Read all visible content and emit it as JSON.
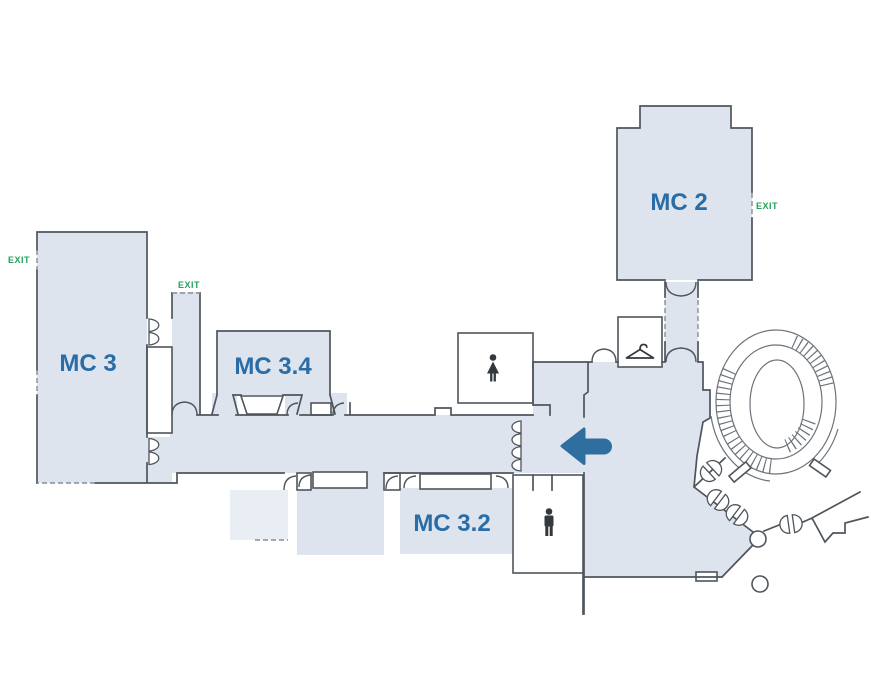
{
  "page": {
    "type": "venue-floor-plan"
  },
  "rooms": {
    "mc2": {
      "label": "MC 2"
    },
    "mc3": {
      "label": "MC 3"
    },
    "mc34": {
      "label": "MC 3.4"
    },
    "mc32": {
      "label": "MC 3.2"
    }
  },
  "exits": {
    "mc3_left": "EXIT",
    "mc3_top": "EXIT",
    "mc2_right": "EXIT"
  },
  "icons": {
    "womens_restroom": "womens-restroom-icon",
    "mens_restroom": "mens-restroom-icon",
    "cloakroom": "coat-hanger-icon",
    "direction": "left-arrow-icon",
    "staircase": "spiral-staircase"
  },
  "colors": {
    "background": "#ffffff",
    "room_fill": "#dde4ee",
    "room_fill_light": "#e9edf4",
    "wall": "#4e555c",
    "wall_dashed": "#878d95",
    "label_blue": "#2a6ca5",
    "exit_green": "#21a25a",
    "arrow_blue": "#2e6f9f",
    "icon_dark": "#33383d"
  }
}
